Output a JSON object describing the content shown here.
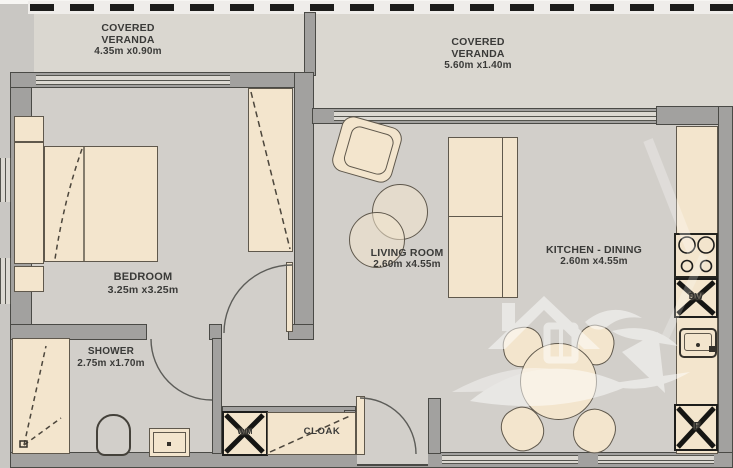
{
  "meta": {
    "drawing_type": "apartment floor plan"
  },
  "rooms": {
    "veranda_left": {
      "line1": "COVERED",
      "line2": "VERANDA",
      "dims": "4.35m x0.90m"
    },
    "veranda_right": {
      "line1": "COVERED",
      "line2": "VERANDA",
      "dims": "5.60m x1.40m"
    },
    "bedroom": {
      "name": "BEDROOM",
      "dims": "3.25m x3.25m"
    },
    "shower": {
      "name": "SHOWER",
      "dims": "2.75m x1.70m"
    },
    "living": {
      "name": "LIVING ROOM",
      "dims": "2.60m x4.55m"
    },
    "kitchen": {
      "name": "KITCHEN - DINING",
      "dims": "2.60m x4.55m"
    }
  },
  "fixtures": {
    "washing_machine": "W/M",
    "cloak": "CLOAK",
    "dishwasher": "DW",
    "fridge": "F"
  },
  "icons": {
    "watermark_logo": "house-bird-logo"
  },
  "colors": {
    "wall": "#a2a19f",
    "floor": "#d2cfca",
    "veranda_floor": "#dad7d0",
    "furniture": "#f3e5cd",
    "outline": "#4a4a46",
    "railing": "#1c1c1a",
    "background": "#c9c7c3"
  }
}
